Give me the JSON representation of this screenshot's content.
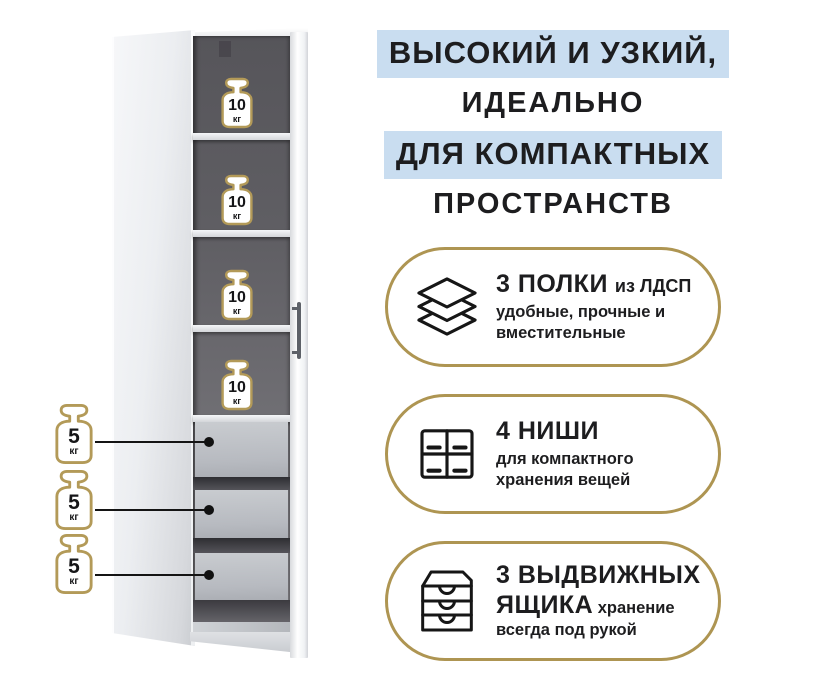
{
  "title_lines": [
    {
      "text": "ВЫСОКИЙ  И  УЗКИЙ,",
      "highlighted": true
    },
    {
      "text": "ИДЕАЛЬНО",
      "highlighted": false
    },
    {
      "text": "ДЛЯ КОМПАКТНЫХ",
      "highlighted": true
    },
    {
      "text": "ПРОСТРАНСТВ",
      "highlighted": false
    }
  ],
  "features": [
    {
      "icon": "shelves-layers-icon",
      "title": "3 ПОЛКИ",
      "title_suffix": "из ЛДСП",
      "description": "удобные, прочные и вместительные"
    },
    {
      "icon": "niches-grid-icon",
      "title": "4 НИШИ",
      "title_suffix": "",
      "description": "для компактного хранения вещей"
    },
    {
      "icon": "drawers-chest-icon",
      "title": "3 ВЫДВИЖНЫХ ЯЩИКА",
      "title_suffix": "",
      "description": "хранение всегда под рукой"
    }
  ],
  "cabinet": {
    "shelf_weights": [
      {
        "value": "10",
        "unit": "кг"
      },
      {
        "value": "10",
        "unit": "кг"
      },
      {
        "value": "10",
        "unit": "кг"
      },
      {
        "value": "10",
        "unit": "кг"
      }
    ],
    "drawer_weights": [
      {
        "value": "5",
        "unit": "кг"
      },
      {
        "value": "5",
        "unit": "кг"
      },
      {
        "value": "5",
        "unit": "кг"
      }
    ]
  },
  "colors": {
    "accent_gold": "#ae9552",
    "highlight_blue": "#c9ddf0",
    "text_dark": "#1d1d1f"
  }
}
